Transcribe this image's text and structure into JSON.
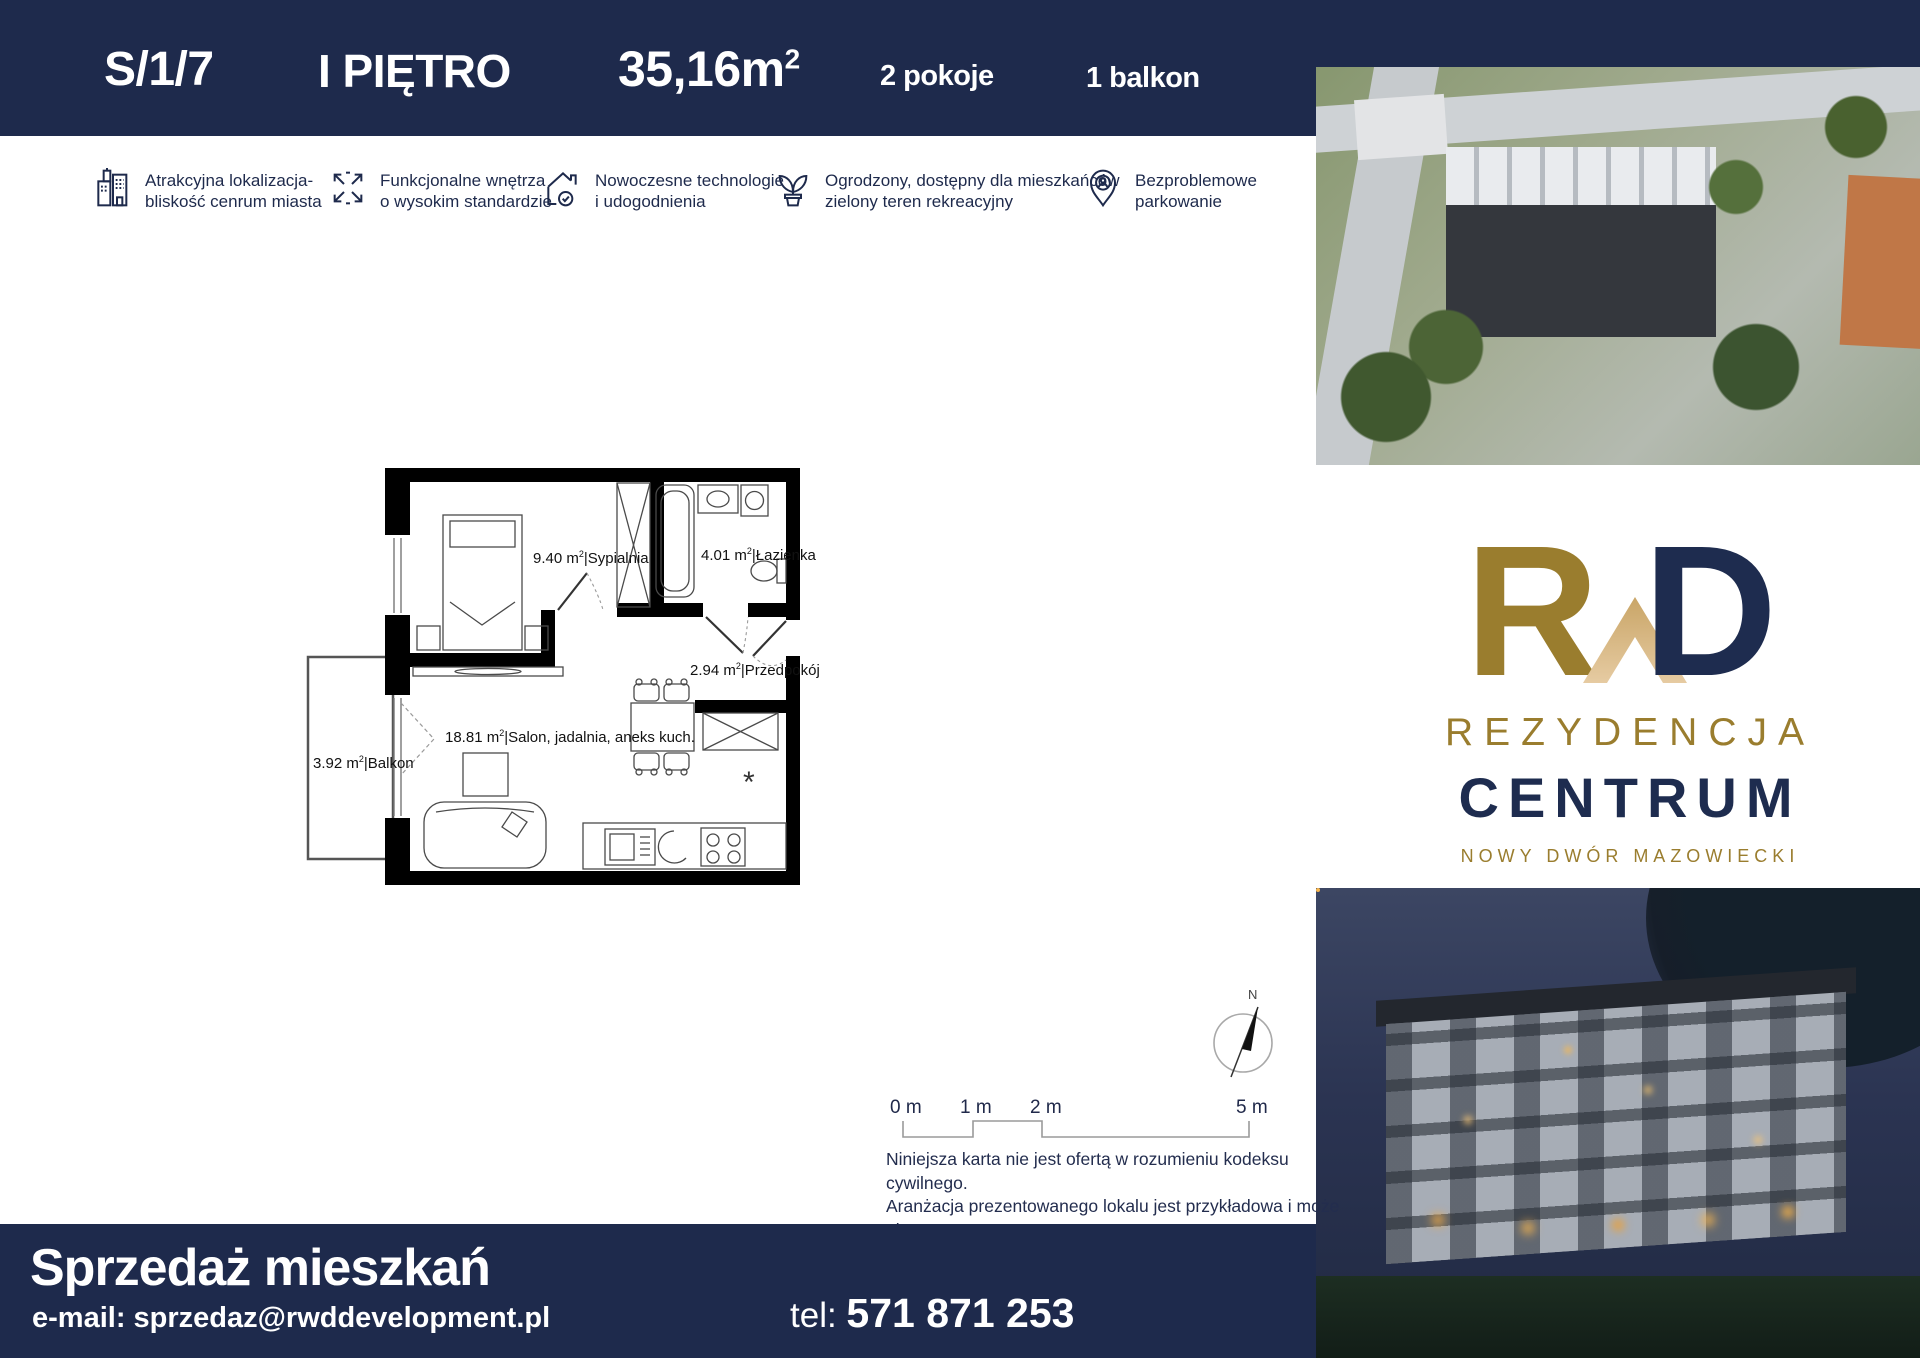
{
  "colors": {
    "navy": "#1e2a4c",
    "gold": "#9a7d2e",
    "tan": "#dcb98c",
    "wall": "#000000"
  },
  "header": {
    "unit": "S/1/7",
    "floor": "I PIĘTRO",
    "area": "35,16m",
    "area_sup": "2",
    "rooms": "2 pokoje",
    "balcony": "1 balkon"
  },
  "features": [
    {
      "icon": "buildings-icon",
      "line1": "Atrakcyjna lokalizacja-",
      "line2": "bliskość cenrum miasta"
    },
    {
      "icon": "expand-arrows-icon",
      "line1": "Funkcjonalne wnętrza",
      "line2": "o wysokim standardzie"
    },
    {
      "icon": "house-check-icon",
      "line1": "Nowoczesne technologie",
      "line2": "i udogodnienia"
    },
    {
      "icon": "plant-icon",
      "line1": "Ogrodzony, dostępny dla mieszkańców",
      "line2": "zielony teren rekreacyjny"
    },
    {
      "icon": "parking-pin-icon",
      "line1": "Bezproblemowe",
      "line2": "parkowanie"
    }
  ],
  "floor_plan": {
    "sup": "2",
    "divider": "|",
    "rooms": [
      {
        "area": "9.40 m",
        "name": "Sypialnia"
      },
      {
        "area": "4.01 m",
        "name": "Łazienka"
      },
      {
        "area": "2.94 m",
        "name": "Przedpokój"
      },
      {
        "area": "18.81 m",
        "name": "Salon, jadalnia, aneks kuch."
      },
      {
        "area": "3.92 m",
        "name": "Balkon"
      }
    ],
    "fridge_mark": "*"
  },
  "scale_bar": {
    "labels": [
      "0 m",
      "1 m",
      "2 m",
      "5 m"
    ]
  },
  "compass": {
    "north": "N"
  },
  "disclaimer": {
    "lines": [
      "Niniejsza karta nie jest ofertą w rozumieniu kodeksu cywilnego.",
      "Aranżacja prezentowanego lokalu jest przykładowa i może ulec",
      "zmianie. Podziałka podana z tolerancją 5%."
    ]
  },
  "logo": {
    "letter_r": "R",
    "letter_d": "D",
    "line1": "REZYDENCJA",
    "line2": "CENTRUM",
    "line3": "NOWY DWÓR MAZOWIECKI"
  },
  "footer": {
    "title": "Sprzedaż mieszkań",
    "email": "e-mail: sprzedaz@rwddevelopment.pl",
    "phone_label": "tel: ",
    "phone": "571 871 253"
  }
}
